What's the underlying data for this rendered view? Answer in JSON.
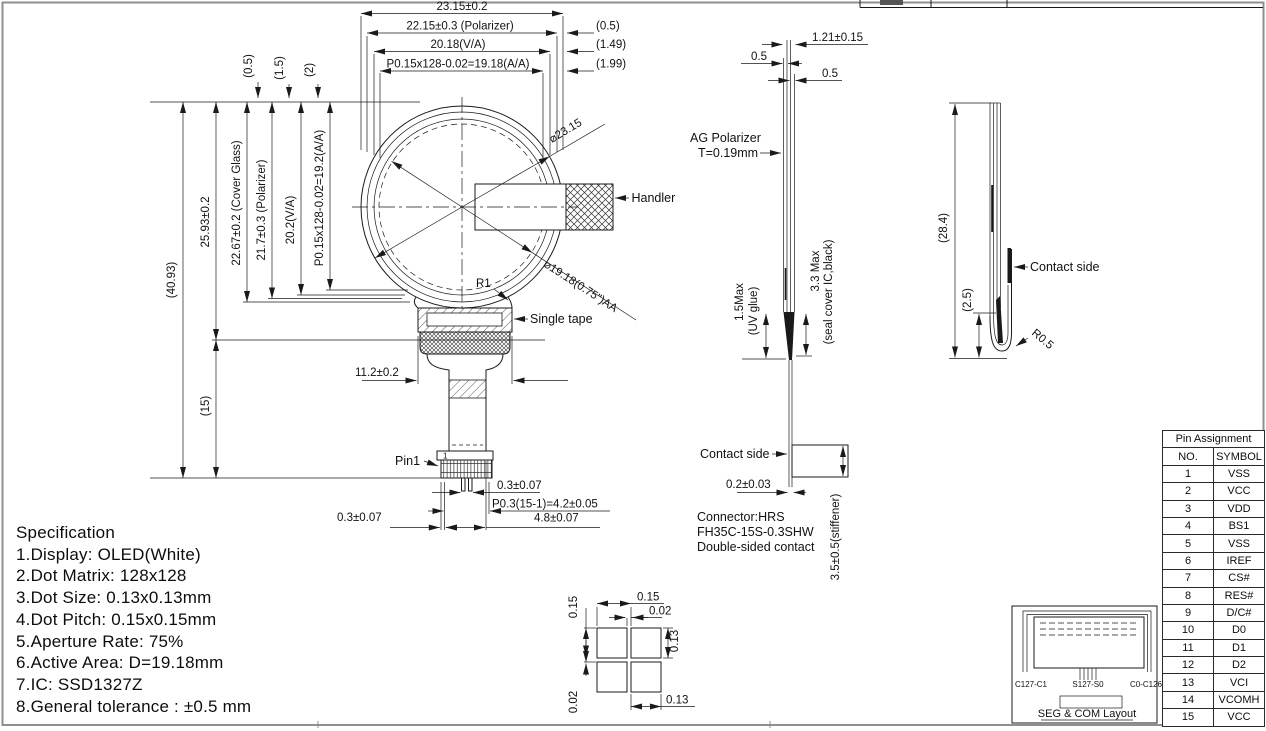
{
  "front": {
    "dim_23": "23.15±0.2",
    "dim_2215": "22.15±0.3 (Polarizer)",
    "dim_2018": "20.18(V/A)",
    "dim_p015h": "P0.15x128-0.02=19.18(A/A)",
    "dim_05r": "(0.5)",
    "dim_149": "(1.49)",
    "dim_199": "(1.99)",
    "rot_05": "(0.5)",
    "rot_15": "(1.5)",
    "rot_2": "(2)",
    "dim_4093": "(40.93)",
    "dim_2593": "25.93±0.2",
    "dim_15": "(15)",
    "dim_2267": "22.67±0.2 (Cover Glass)",
    "dim_217": "21.7±0.3 (Polarizer)",
    "dim_202": "20.2(V/A)",
    "dim_p015v": "P0.15x128-0.02=19.2(A/A)",
    "dia_outer": "⌀23.15",
    "dia_aa": "⌀19.18(0.75\")AA",
    "r1": "R1",
    "handler": "Handler",
    "single_tape": "Single tape",
    "dim_112": "11.2±0.2",
    "pin1": "Pin1",
    "pin1_num": "1",
    "dim_03a": "0.3±0.07",
    "dim_p03": "P0.3(15-1)=4.2±0.05",
    "dim_03b": "0.3±0.07",
    "dim_48": "4.8±0.07"
  },
  "side": {
    "dim_121": "1.21±0.15",
    "dim_05a": "0.5",
    "dim_05b": "0.5",
    "ag1": "AG Polarizer",
    "ag2": "T=0.19mm",
    "uv1": "1.5Max",
    "uv2": "(UV glue)",
    "seal1": "3.3 Max",
    "seal2": "(seal cover IC,black)",
    "contact": "Contact side",
    "dim_02": "0.2±0.03",
    "stiffener": "3.5±0.5(stiffener)",
    "conn1": "Connector:HRS",
    "conn2": "FH35C-15S-0.3SHW",
    "conn3": "Double-sided contact"
  },
  "bent": {
    "dim_284": "(28.4)",
    "dim_25": "(2.5)",
    "contact": "Contact side",
    "r05": "R0.5"
  },
  "dot": {
    "p_h": "0.15",
    "g_h": "0.02",
    "p_v": "0.15",
    "g_v": "0.02",
    "s_v": "0.13",
    "s_h": "0.13"
  },
  "segcom": {
    "left": "C127-C1",
    "mid": "S127-S0",
    "right": "C0-C126",
    "caption": "SEG & COM Layout"
  },
  "spec": {
    "title": "Specification",
    "items": [
      "1.Display: OLED(White)",
      "2.Dot Matrix: 128x128",
      "3.Dot Size: 0.13x0.13mm",
      "4.Dot Pitch: 0.15x0.15mm",
      "5.Aperture Rate: 75%",
      "6.Active Area: D=19.18mm",
      "7.IC: SSD1327Z",
      "8.General tolerance : ±0.5 mm"
    ]
  },
  "pins": {
    "title": "Pin Assignment",
    "h_no": "NO.",
    "h_sym": "SYMBOL",
    "rows": [
      [
        "1",
        "VSS"
      ],
      [
        "2",
        "VCC"
      ],
      [
        "3",
        "VDD"
      ],
      [
        "4",
        "BS1"
      ],
      [
        "5",
        "VSS"
      ],
      [
        "6",
        "IREF"
      ],
      [
        "7",
        "CS#"
      ],
      [
        "8",
        "RES#"
      ],
      [
        "9",
        "D/C#"
      ],
      [
        "10",
        "D0"
      ],
      [
        "11",
        "D1"
      ],
      [
        "12",
        "D2"
      ],
      [
        "13",
        "VCI"
      ],
      [
        "14",
        "VCOMH"
      ],
      [
        "15",
        "VCC"
      ]
    ]
  }
}
